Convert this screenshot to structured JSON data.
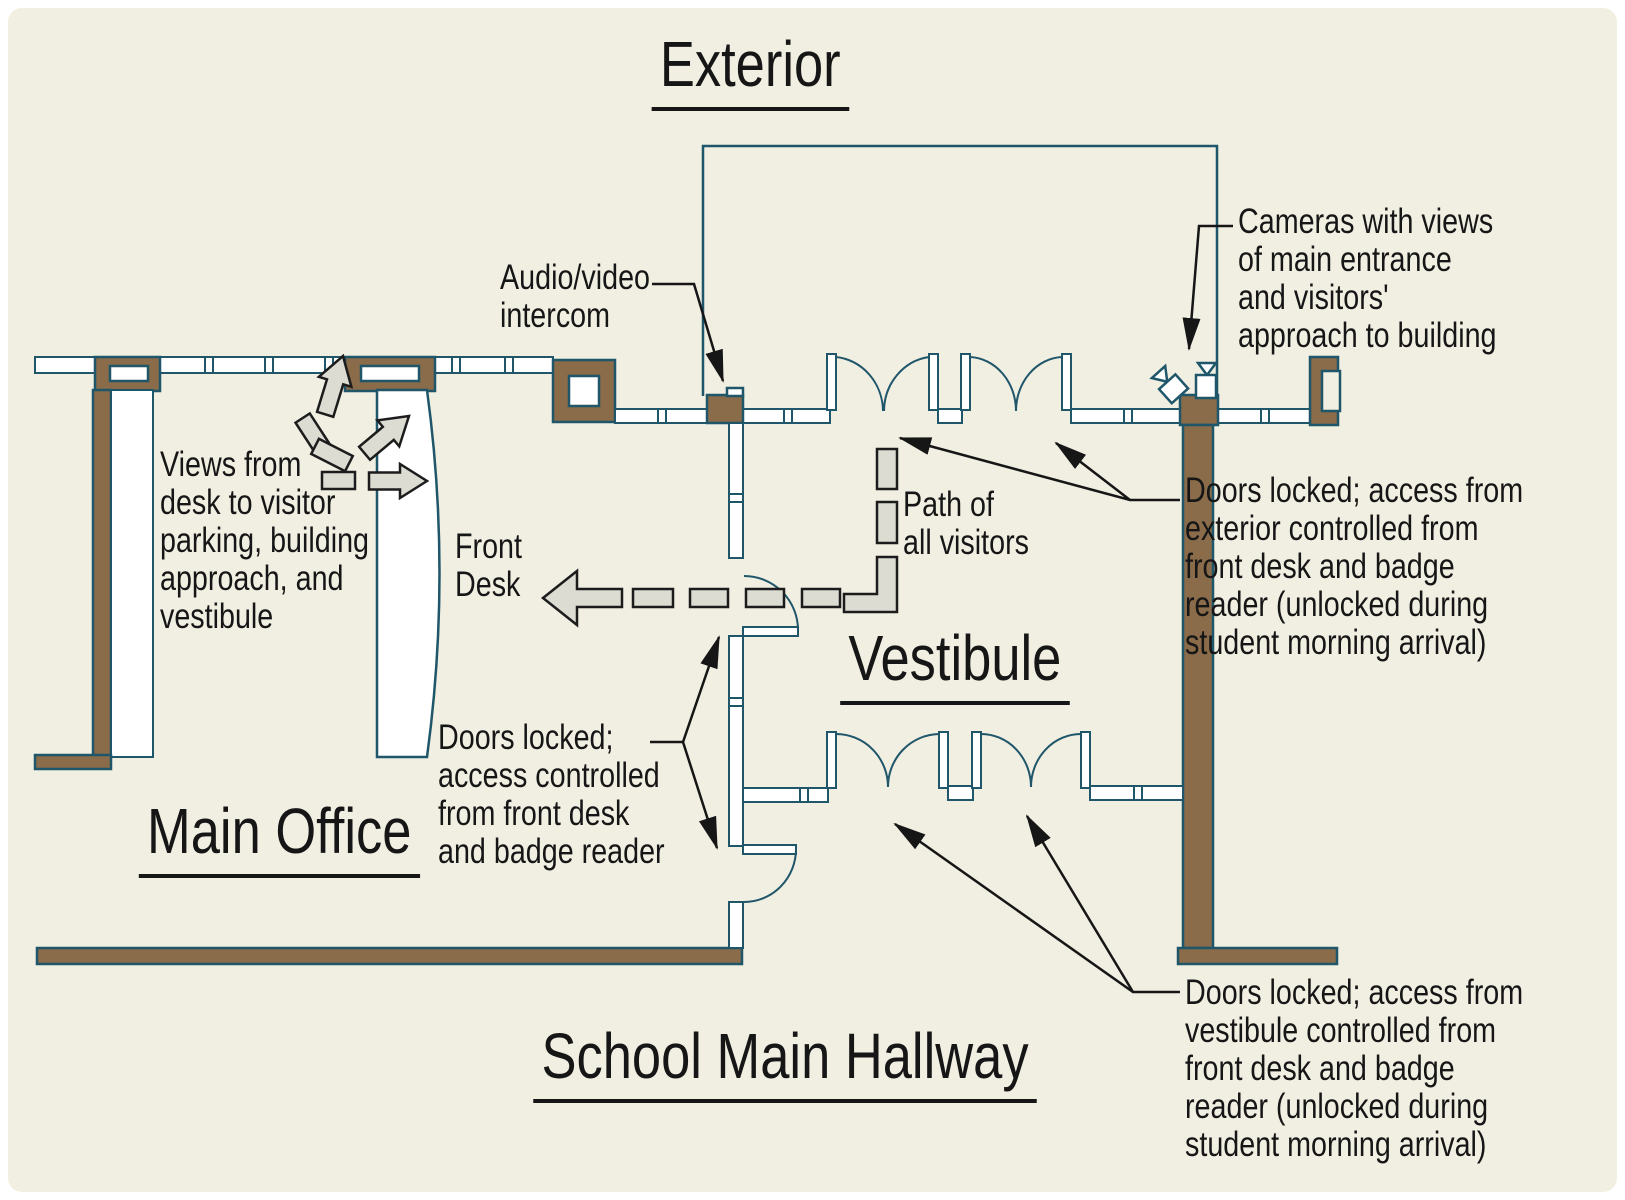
{
  "rooms": {
    "exterior": "Exterior",
    "vestibule": "Vestibule",
    "main_office": "Main Office",
    "hallway": "School Main Hallway"
  },
  "labels": {
    "front_desk": {
      "line1": "Front",
      "line2": "Desk"
    },
    "path": {
      "line1": "Path of",
      "line2": "all visitors"
    },
    "intercom": {
      "line1": "Audio/video",
      "line2": "intercom"
    },
    "views": {
      "line1": "Views from",
      "line2": "desk to visitor",
      "line3": "parking, building",
      "line4": "approach, and",
      "line5": "vestibule"
    },
    "doors_office": {
      "line1": "Doors locked;",
      "line2": "access controlled",
      "line3": "from front desk",
      "line4": "and badge reader"
    },
    "doors_exterior": {
      "line1": "Doors locked; access from",
      "line2": "exterior controlled from",
      "line3": "front desk and badge",
      "line4": "reader (unlocked during",
      "line5": "student morning arrival)"
    },
    "doors_vestibule": {
      "line1": "Doors locked; access from",
      "line2": "vestibule controlled from",
      "line3": "front desk and badge",
      "line4": "reader (unlocked during",
      "line5": "student morning arrival)"
    },
    "cameras": {
      "line1": "Cameras with views",
      "line2": "of main entrance",
      "line3": "and visitors'",
      "line4": "approach to building"
    }
  },
  "icons": {
    "camera_upright": "security-camera-icon",
    "camera_tilted": "security-camera-icon",
    "view_arrows": "sightline-arrow-icon",
    "path_arrow": "visitor-path-arrow-icon"
  },
  "colors": {
    "background": "#f1eee2",
    "wall_brown": "#8a6b4a",
    "line_teal": "#1f566a",
    "arrow_gray_fill": "#dcdcd3",
    "leader_black": "#161616"
  }
}
